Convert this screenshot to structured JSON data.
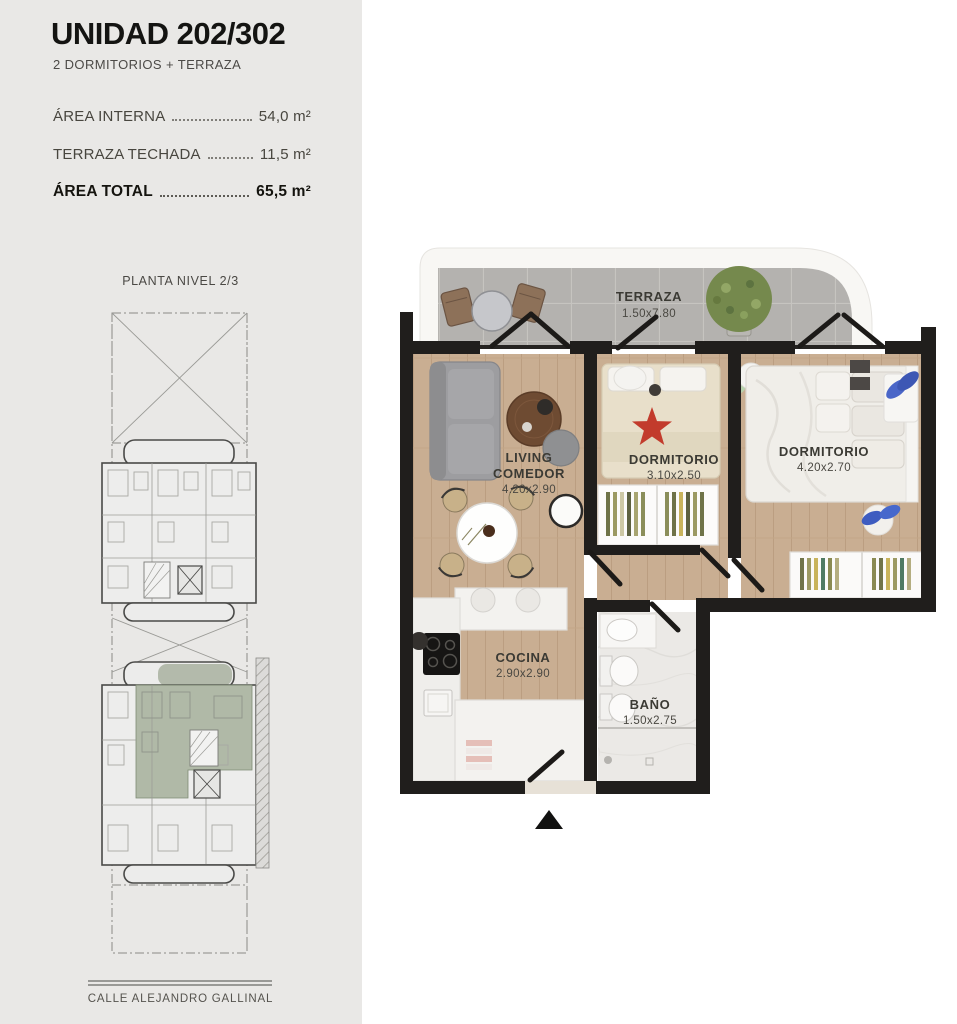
{
  "unit": {
    "title": "UNIDAD 202/302",
    "subtitle": "2 DORMITORIOS + TERRAZA"
  },
  "areas": [
    {
      "label": "ÁREA INTERNA",
      "value": "54,0 m²"
    },
    {
      "label": "TERRAZA TECHADA",
      "value": "11,5 m²"
    },
    {
      "label": "ÁREA TOTAL",
      "value": "65,5 m²"
    }
  ],
  "site_plan": {
    "title": "PLANTA NIVEL 2/3",
    "street": "CALLE ALEJANDRO GALLINAL"
  },
  "floor_plan": {
    "rooms": {
      "terraza": {
        "name": "TERRAZA",
        "dims": "1.50x7.80"
      },
      "living": {
        "line1": "LIVING",
        "line2": "COMEDOR",
        "dims": "4.20x2.90"
      },
      "dormitorio1": {
        "name": "DORMITORIO",
        "dims": "3.10x2.50"
      },
      "dormitorio2": {
        "name": "DORMITORIO",
        "dims": "4.20x2.70"
      },
      "cocina": {
        "name": "COCINA",
        "dims": "2.90x2.90"
      },
      "bano": {
        "name": "BAÑO",
        "dims": "1.50x2.75"
      }
    }
  },
  "colors": {
    "sidebar_bg": "#e9e8e6",
    "wall_black": "#1e1c1a",
    "wood_floor": "#c9ad90",
    "terrace_tile": "#b3b1ae",
    "highlight_unit_green": "#a9b2a0",
    "label_text": "#3b3a36"
  }
}
